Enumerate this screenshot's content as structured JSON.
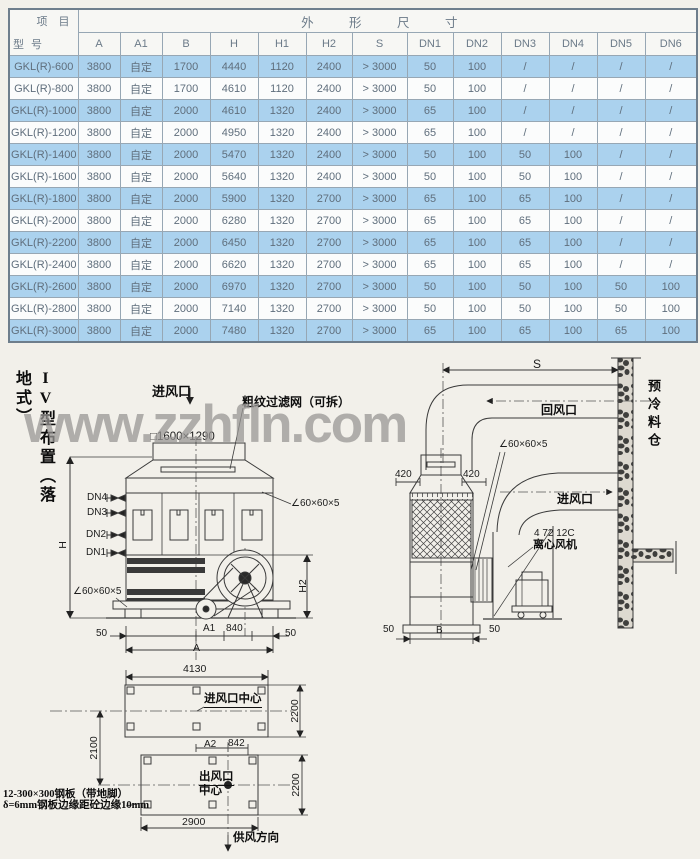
{
  "colors": {
    "row_blue": "#abd2ee",
    "row_white": "#fbfcfc",
    "border": "#97a7b4",
    "line": "#3a3a3a"
  },
  "table": {
    "corner": {
      "top": "项 目",
      "bottom": "型 号"
    },
    "span_header": "外 形 尺 寸",
    "columns": [
      "A",
      "A1",
      "B",
      "H",
      "H1",
      "H2",
      "S",
      "DN1",
      "DN2",
      "DN3",
      "DN4",
      "DN5",
      "DN6"
    ],
    "rows": [
      {
        "model": "GKL(R)-600",
        "values": [
          "3800",
          "自定",
          "1700",
          "4440",
          "1120",
          "2400",
          "> 3000",
          "50",
          "100",
          "/",
          "/",
          "/",
          "/"
        ]
      },
      {
        "model": "GKL(R)-800",
        "values": [
          "3800",
          "自定",
          "1700",
          "4610",
          "1120",
          "2400",
          "> 3000",
          "50",
          "100",
          "/",
          "/",
          "/",
          "/"
        ]
      },
      {
        "model": "GKL(R)-1000",
        "values": [
          "3800",
          "自定",
          "2000",
          "4610",
          "1320",
          "2400",
          "> 3000",
          "65",
          "100",
          "/",
          "/",
          "/",
          "/"
        ]
      },
      {
        "model": "GKL(R)-1200",
        "values": [
          "3800",
          "自定",
          "2000",
          "4950",
          "1320",
          "2400",
          "> 3000",
          "65",
          "100",
          "/",
          "/",
          "/",
          "/"
        ]
      },
      {
        "model": "GKL(R)-1400",
        "values": [
          "3800",
          "自定",
          "2000",
          "5470",
          "1320",
          "2400",
          "> 3000",
          "50",
          "100",
          "50",
          "100",
          "/",
          "/"
        ]
      },
      {
        "model": "GKL(R)-1600",
        "values": [
          "3800",
          "自定",
          "2000",
          "5640",
          "1320",
          "2400",
          "> 3000",
          "50",
          "100",
          "50",
          "100",
          "/",
          "/"
        ]
      },
      {
        "model": "GKL(R)-1800",
        "values": [
          "3800",
          "自定",
          "2000",
          "5900",
          "1320",
          "2700",
          "> 3000",
          "65",
          "100",
          "65",
          "100",
          "/",
          "/"
        ]
      },
      {
        "model": "GKL(R)-2000",
        "values": [
          "3800",
          "自定",
          "2000",
          "6280",
          "1320",
          "2700",
          "> 3000",
          "65",
          "100",
          "65",
          "100",
          "/",
          "/"
        ]
      },
      {
        "model": "GKL(R)-2200",
        "values": [
          "3800",
          "自定",
          "2000",
          "6450",
          "1320",
          "2700",
          "> 3000",
          "65",
          "100",
          "65",
          "100",
          "/",
          "/"
        ]
      },
      {
        "model": "GKL(R)-2400",
        "values": [
          "3800",
          "自定",
          "2000",
          "6620",
          "1320",
          "2700",
          "> 3000",
          "65",
          "100",
          "65",
          "100",
          "/",
          "/"
        ]
      },
      {
        "model": "GKL(R)-2600",
        "values": [
          "3800",
          "自定",
          "2000",
          "6970",
          "1320",
          "2700",
          "> 3000",
          "50",
          "100",
          "50",
          "100",
          "50",
          "100"
        ]
      },
      {
        "model": "GKL(R)-2800",
        "values": [
          "3800",
          "自定",
          "2000",
          "7140",
          "1320",
          "2700",
          "> 3000",
          "50",
          "100",
          "50",
          "100",
          "50",
          "100"
        ]
      },
      {
        "model": "GKL(R)-3000",
        "values": [
          "3800",
          "自定",
          "2000",
          "7480",
          "1320",
          "2700",
          "> 3000",
          "65",
          "100",
          "65",
          "100",
          "65",
          "100"
        ]
      }
    ]
  },
  "diagram": {
    "section_label": "IV型布置（落地式）",
    "watermark": "www.zzhfln.com",
    "front": {
      "air_inlet": "进风口",
      "filter_note": "粗纹过滤网（可拆）",
      "duct_size": "□1600×1290",
      "dn4": "DN4",
      "dn3": "DN3",
      "dn2": "DN2",
      "dn1": "DN1",
      "h": "H",
      "h2": "H2",
      "angle_right": "∠60×60×5",
      "angle_left": "∠60×60×5",
      "dim_50_left": "50",
      "dim_a1": "A1",
      "dim_840": "840",
      "dim_50_right": "50",
      "dim_a": "A"
    },
    "side": {
      "dim_s": "S",
      "return_air": "回风口",
      "air_inlet": "进风口",
      "precool_bin": "预冷料仓",
      "angle": "∠60×60×5",
      "dim_420_left": "420",
      "dim_420_right": "420",
      "fan_model": "4 72 12C",
      "fan_name": "离心风机",
      "dim_50_left": "50",
      "dim_b": "B",
      "dim_50_right": "50"
    },
    "plan": {
      "dim_4130": "4130",
      "inlet_center": "进风口中心",
      "dim_2200_top": "2200",
      "dim_2100": "2100",
      "dim_a2": "A2",
      "dim_842": "842",
      "outlet_center_1": "出风口",
      "outlet_center_2": "中心",
      "dim_2200_bottom": "2200",
      "dim_2900": "2900",
      "supply_dir": "供风方向",
      "note_line1": "12-300×300钢板（带地脚）",
      "note_line2": "δ=6mm钢板边缘距砼边缘10mm"
    }
  }
}
